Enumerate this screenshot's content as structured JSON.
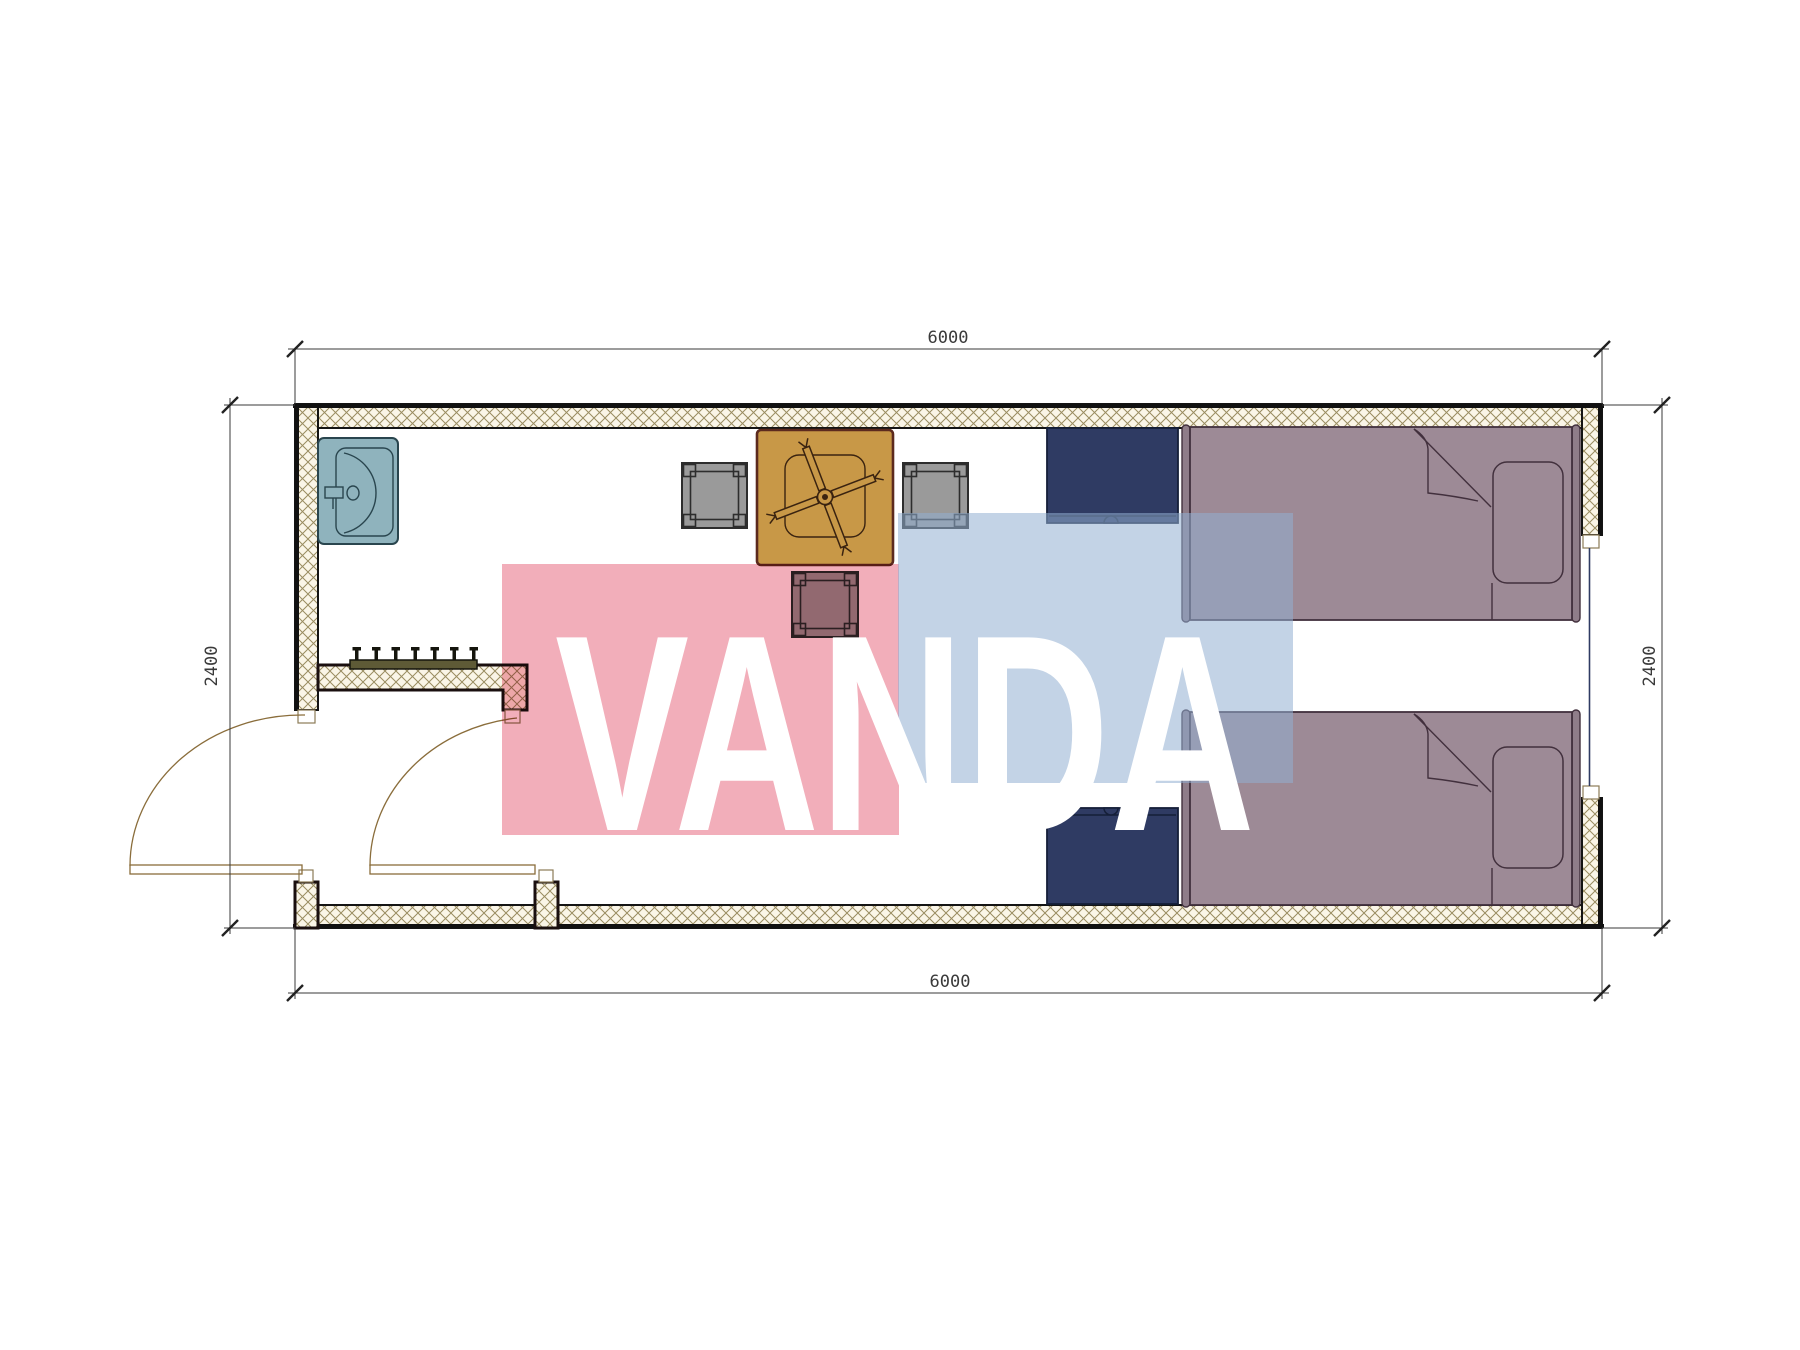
{
  "plan": {
    "dimensions": {
      "top": "6000",
      "bottom": "6000",
      "left": "2400",
      "right": "2400"
    },
    "watermark": {
      "text": "VANDA",
      "pink": "#F2AEBA",
      "blue": "#92AFD1",
      "letters": "#FFFFFF"
    },
    "colors": {
      "wall_hatch_bg": "#FAF5E7",
      "wall_hatch_line": "#998C60",
      "wall_outline": "#141414",
      "sink": "#8FB3BD",
      "table": "#C89847",
      "chair_gray": "#9A9A9A",
      "nightstand_navy": "#2F3B63",
      "bed_mauve": "#9D8A96",
      "coat_rack": "#5E5A36",
      "door_arc": "#8A6D3B",
      "dimension_text": "#3A3A3A"
    }
  }
}
